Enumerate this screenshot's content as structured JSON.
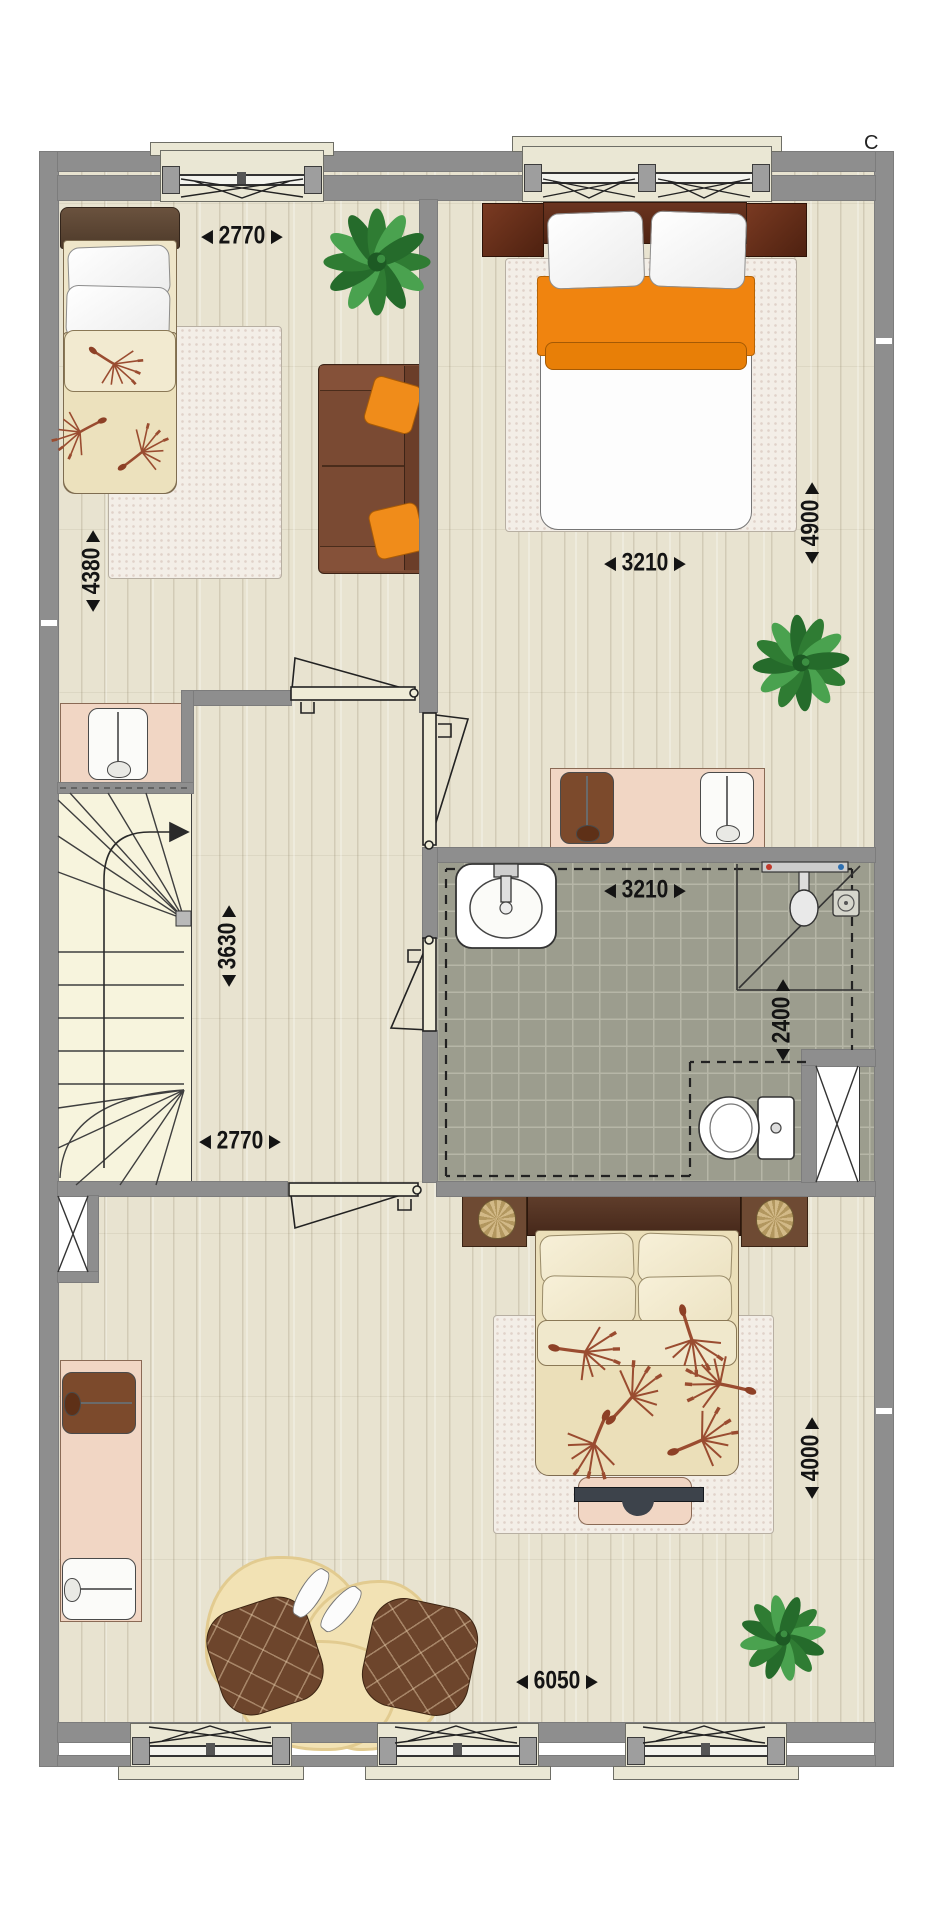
{
  "marker": {
    "top_right": "C"
  },
  "glyphs": {
    "arrow_start": "◀",
    "arrow_end": "▶"
  },
  "dimensions": {
    "bedroom1_width": {
      "value": "2770",
      "orientation": "horizontal"
    },
    "bedroom1_depth": {
      "value": "4380",
      "orientation": "vertical"
    },
    "bedroom2_width": {
      "value": "3210",
      "orientation": "horizontal"
    },
    "bedroom2_depth": {
      "value": "4900",
      "orientation": "vertical"
    },
    "landing_depth": {
      "value": "3630",
      "orientation": "vertical"
    },
    "landing_width": {
      "value": "2770",
      "orientation": "horizontal"
    },
    "bathroom_width": {
      "value": "3210",
      "orientation": "horizontal"
    },
    "bathroom_depth": {
      "value": "2400",
      "orientation": "vertical"
    },
    "bedroom3_width": {
      "value": "6050",
      "orientation": "horizontal"
    },
    "bedroom3_depth": {
      "value": "4000",
      "orientation": "vertical"
    }
  },
  "rooms": [
    {
      "id": "bedroom-top-left",
      "furniture": [
        "single-bed",
        "rug",
        "sofa",
        "orange-cushions",
        "plant",
        "desk",
        "chair"
      ]
    },
    {
      "id": "bedroom-top-right",
      "furniture": [
        "double-bed",
        "orange-throw",
        "nightstand",
        "nightstand",
        "rug",
        "plant",
        "desk",
        "chair",
        "chair"
      ]
    },
    {
      "id": "landing",
      "furniture": [
        "staircase",
        "stair-direction-arrow"
      ]
    },
    {
      "id": "bathroom",
      "furniture": [
        "washbasin",
        "shower-corner",
        "shower-drain",
        "toilet",
        "duct"
      ]
    },
    {
      "id": "bedroom-bottom",
      "furniture": [
        "double-bed",
        "nightstand-basket",
        "nightstand-basket",
        "rug",
        "foot-bench",
        "desk",
        "chair",
        "chair",
        "sheepskin-rug",
        "pouf",
        "pouf",
        "slippers",
        "plant",
        "duct"
      ]
    }
  ],
  "window_count": {
    "top": 2,
    "bottom": 3
  },
  "door_count": 4,
  "colors": {
    "wall": "#8e8e8e",
    "wood_floor": "#e8e3d0",
    "bath_tile": "#9c9d8e",
    "accent_orange": "#f0840f",
    "furniture_brown": "#7c4a2c",
    "desk_pink": "#f1d6c4",
    "stair_fill": "#f7f4dd",
    "dimension_text": "#141414"
  }
}
